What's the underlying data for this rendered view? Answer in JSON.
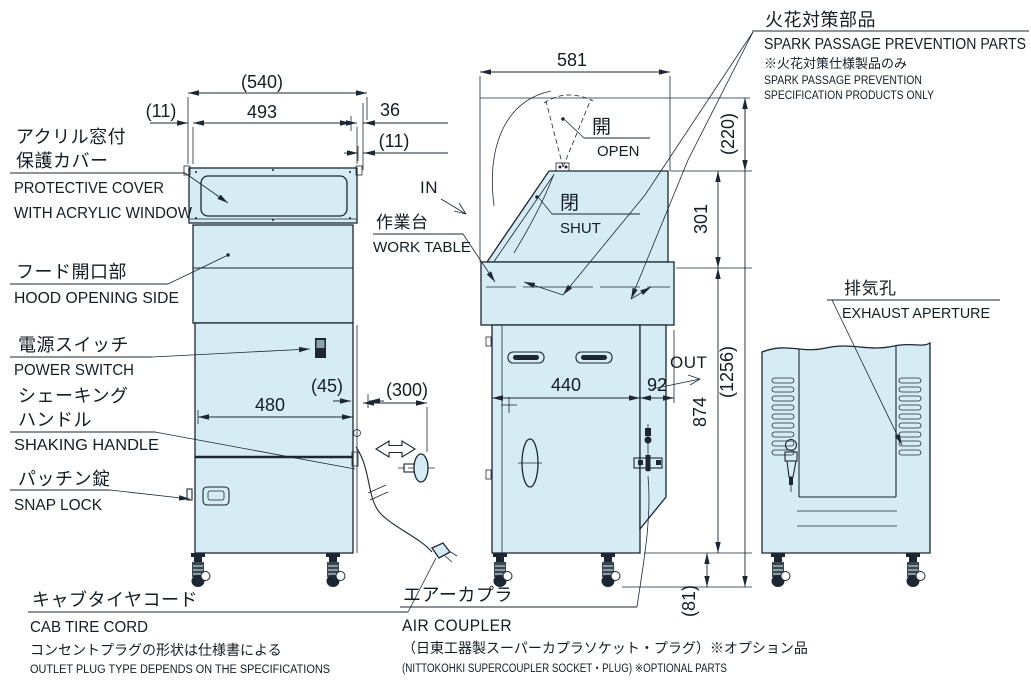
{
  "drawing": {
    "colors": {
      "panel_fill": "#d6ecf4",
      "line": "#1c2733",
      "background": "#ffffff"
    },
    "labels": {
      "protective_cover_jp1": "アクリル窓付",
      "protective_cover_jp2": "保護カバー",
      "protective_cover_en1": "PROTECTIVE COVER",
      "protective_cover_en2": "WITH ACRYLIC WINDOW",
      "hood_jp": "フード開口部",
      "hood_en": "HOOD OPENING SIDE",
      "power_jp": "電源スイッチ",
      "power_en": "POWER SWITCH",
      "shaking_jp1": "シェーキング",
      "shaking_jp2": "ハンドル",
      "shaking_en": "SHAKING HANDLE",
      "snap_jp": "パッチン錠",
      "snap_en": "SNAP LOCK",
      "cab_jp": "キャブタイヤコード",
      "cab_en": "CAB TIRE CORD",
      "outlet_note_jp": "コンセントプラグの形状は仕様書による",
      "outlet_note_en": "OUTLET PLUG TYPE DEPENDS  ON THE SPECIFICATIONS",
      "worktable_jp": "作業台",
      "worktable_en": "WORK TABLE",
      "in_label": "IN",
      "out_label": "OUT",
      "open_jp": "開",
      "open_en": "OPEN",
      "shut_jp": "閉",
      "shut_en": "SHUT",
      "spark_jp": "火花対策部品",
      "spark_en": "SPARK PASSAGE PREVENTION PARTS",
      "spark_note_jp": "※火花対策仕様製品のみ",
      "spark_note_en1": "SPARK PASSAGE PREVENTION",
      "spark_note_en2": "SPECIFICATION PRODUCTS ONLY",
      "exhaust_jp": "排気孔",
      "exhaust_en": "EXHAUST APERTURE",
      "air_jp": "エアーカプラ",
      "air_en": "AIR COUPLER",
      "air_note_jp": "（日東工器製スーパーカプラソケット・プラグ）※オプション品",
      "air_note_en": "(NITTOKOHKI SUPERCOUPLER SOCKET・PLUG) ※OPTIONAL PARTS"
    },
    "dimensions": {
      "top_total": "(540)",
      "top_width": "493",
      "left_offset": "(11)",
      "right_offset": "36",
      "right_offset2": "(11)",
      "front_width": "480",
      "front_gap": "(45)",
      "handle_stroke": "(300)",
      "side_width": "581",
      "side_top": "(220)",
      "side_hood": "301",
      "side_body": "440",
      "side_panel": "92",
      "side_height": "874",
      "total_height": "(1256)",
      "caster_height": "(81)"
    }
  }
}
